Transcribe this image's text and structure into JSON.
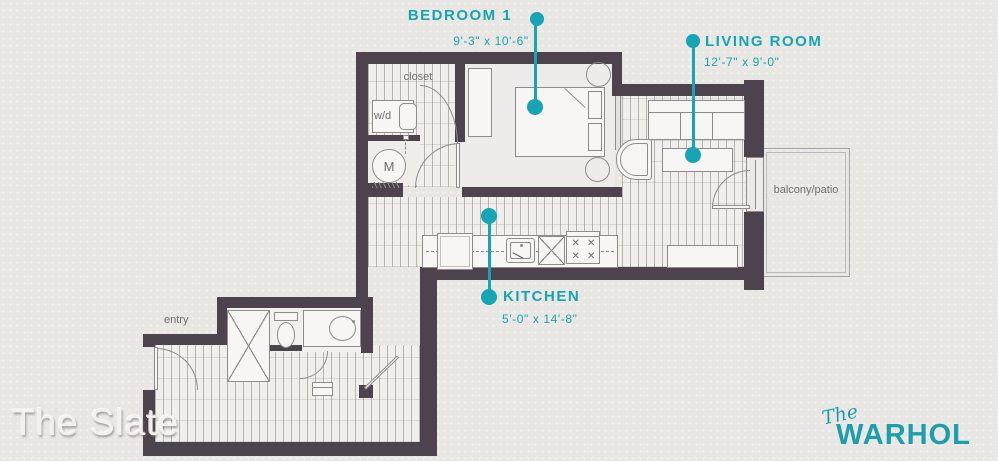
{
  "palette": {
    "teal": "#16a5b4",
    "wall": "#4d434c",
    "background": "#e9e7e4"
  },
  "rooms": {
    "bedroom": {
      "label": "BEDROOM 1",
      "dims": "9'-3\" x 10'-6\""
    },
    "living": {
      "label": "LIVING ROOM",
      "dims": "12'-7\" x 9'-0\""
    },
    "kitchen": {
      "label": "KITCHEN",
      "dims": "5'-0\" x 14'-8\""
    }
  },
  "annotations": {
    "closet": "closet",
    "washer_dryer": "w/d",
    "mechanical": "M",
    "entry": "entry",
    "balcony": "balcony/patio"
  },
  "branding": {
    "plan_name": "The Slate",
    "building_script": "The",
    "building_name": "WARHOL"
  }
}
